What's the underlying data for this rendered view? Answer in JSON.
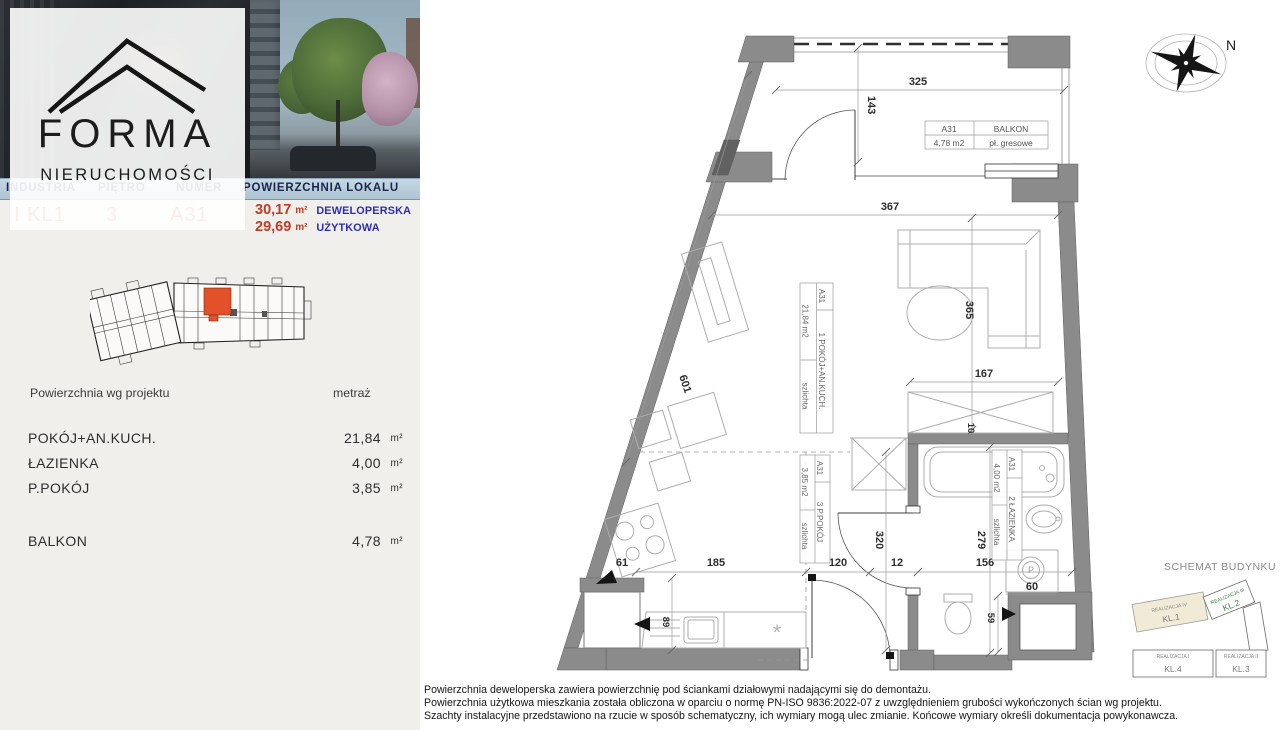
{
  "brand": {
    "name": "FORMA",
    "subtitle": "NIERUCHOMOŚCI"
  },
  "listing": {
    "columns": [
      "INDUSTRIA",
      "PIĘTRO",
      "NUMER",
      "POWIERZCHNIA LOKALU"
    ],
    "values": {
      "industria": "I KL1",
      "pietro": "3",
      "numer": "A31"
    },
    "areas": {
      "deweloperska": {
        "value": "30,17",
        "unit": "m²",
        "label": "DEWELOPERSKA"
      },
      "uzytkowa": {
        "value": "29,69",
        "unit": "m²",
        "label": "UŻYTKOWA"
      }
    }
  },
  "areas_table": {
    "col_left": "Powierzchnia wg projektu",
    "col_right": "metraż",
    "rows": [
      {
        "label": "POKÓJ+AN.KUCH.",
        "value": "21,84",
        "unit": "m²"
      },
      {
        "label": "ŁAZIENKA",
        "value": "4,00",
        "unit": "m²"
      },
      {
        "label": "P.POKÓJ",
        "value": "3,85",
        "unit": "m²"
      }
    ],
    "balcony_row": {
      "label": "BALKON",
      "value": "4,78",
      "unit": "m²"
    }
  },
  "plan": {
    "balcony_label": {
      "code": "A31",
      "name": "BALKON",
      "area": "4,78 m2",
      "finish": "pł. gresowe"
    },
    "room_labels": {
      "pokoj": {
        "code": "A31",
        "area": "21,84 m2",
        "name": "1 POKÓJ+AN.KUCH.",
        "finish": "szlichta"
      },
      "ppokoj": {
        "code": "A31",
        "area": "3,85 m2",
        "name": "3 P.POKÓJ",
        "finish": "szlichta"
      },
      "lazienka": {
        "code": "A31",
        "area": "4,00 m2",
        "name": "2 ŁAZIENKA",
        "finish": "szlichta"
      }
    },
    "dims": {
      "balcony_width": "325",
      "balcony_depth": "143",
      "room_width": "367",
      "room_depth": "365",
      "wardrobe_width": "167",
      "wardrobe_gap": "10",
      "wall_diagonal": "601",
      "kitchen_corner": "61",
      "kitchen_width": "185",
      "hall_width": "120",
      "wall_12": "12",
      "bath_width": "156",
      "hall_depth": "320",
      "bath_depth": "279",
      "entry_gap": "59",
      "washer_width": "60",
      "counter_depth": "89"
    },
    "washer_symbol": "P",
    "compass_label": "N"
  },
  "schemat": {
    "title": "SCHEMAT BUDYNKU",
    "blocks": [
      {
        "name": "REALIZACJA IV",
        "kl": "KL.1"
      },
      {
        "name": "REALIZACJA III",
        "kl": "KL.2"
      },
      {
        "name": "REALIZACJA I",
        "kl": "KL.4"
      },
      {
        "name": "REALIZACJA II",
        "kl": "KL.3"
      }
    ]
  },
  "disclaimer": [
    "Powierzchnia deweloperska zawiera powierzchnię pod ściankami działowymi nadającymi się do demontażu.",
    "Powierzchnia użytkowa mieszkania została obliczona w oparciu o normę  PN-ISO 9836:2022-07 z uwzględnieniem grubości wykończonych ścian wg projektu.",
    "Szachty instalacyjne przedstawiono na rzucie w sposób schematyczny, ich wymiary mogą ulec zmianie. Końcowe wymiary określi dokumentacja powykonawcza."
  ]
}
